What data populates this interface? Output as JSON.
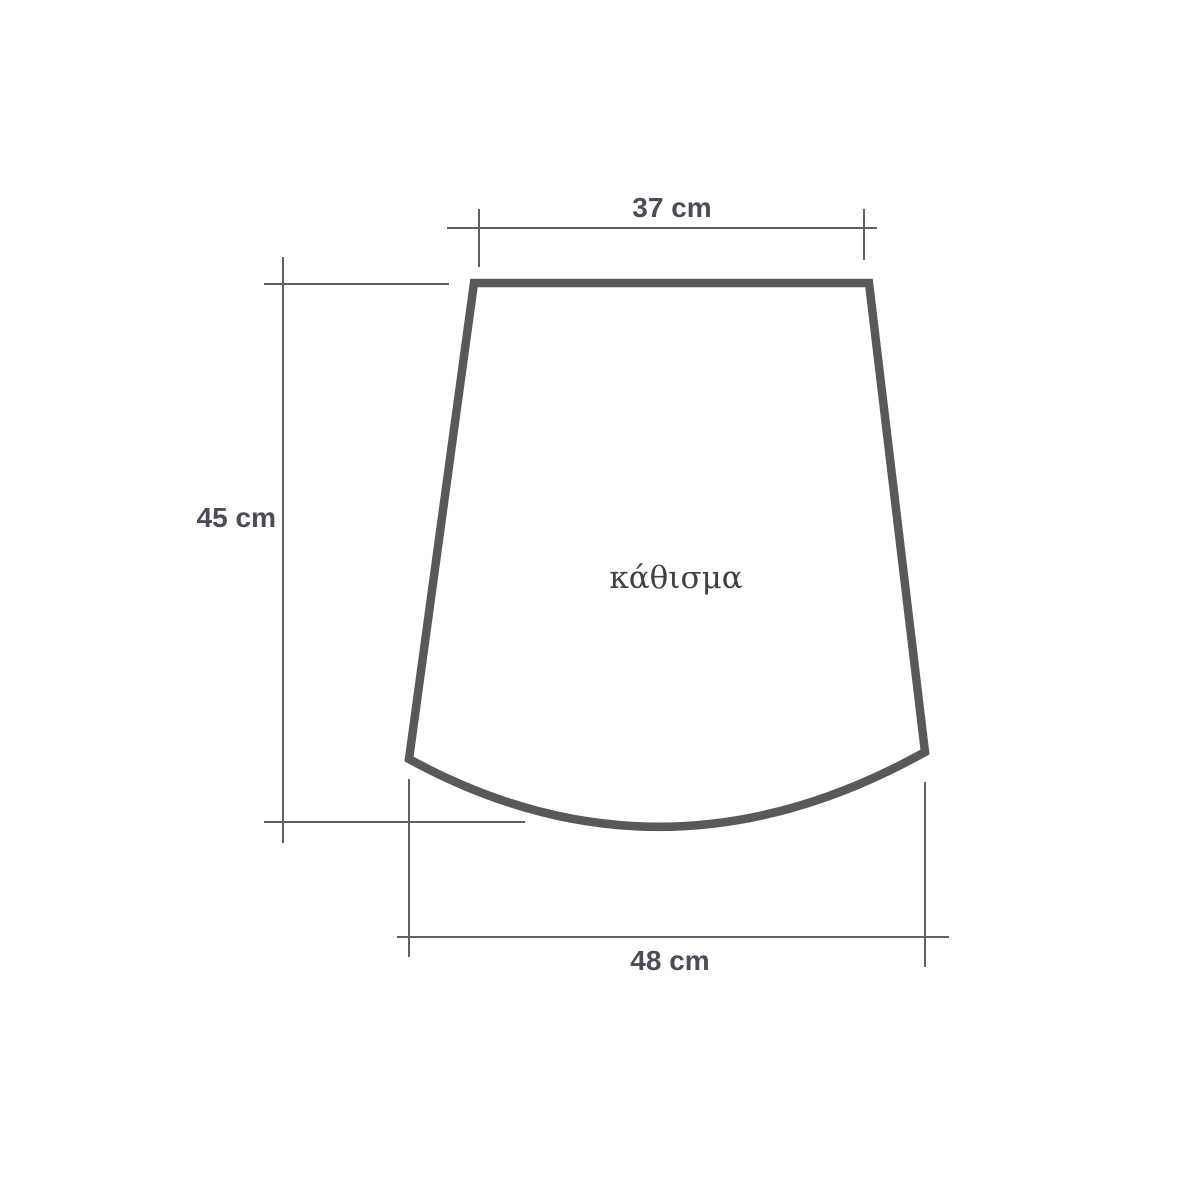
{
  "diagram": {
    "part_label": "κάθισμα",
    "dimensions": {
      "top_width": "37 cm",
      "side_height": "45 cm",
      "bottom_width": "48 cm"
    },
    "colors": {
      "outline": "#595959",
      "dimension_line": "#606060",
      "dimension_text": "#4a4d55",
      "part_label_text": "#3f4043"
    }
  }
}
